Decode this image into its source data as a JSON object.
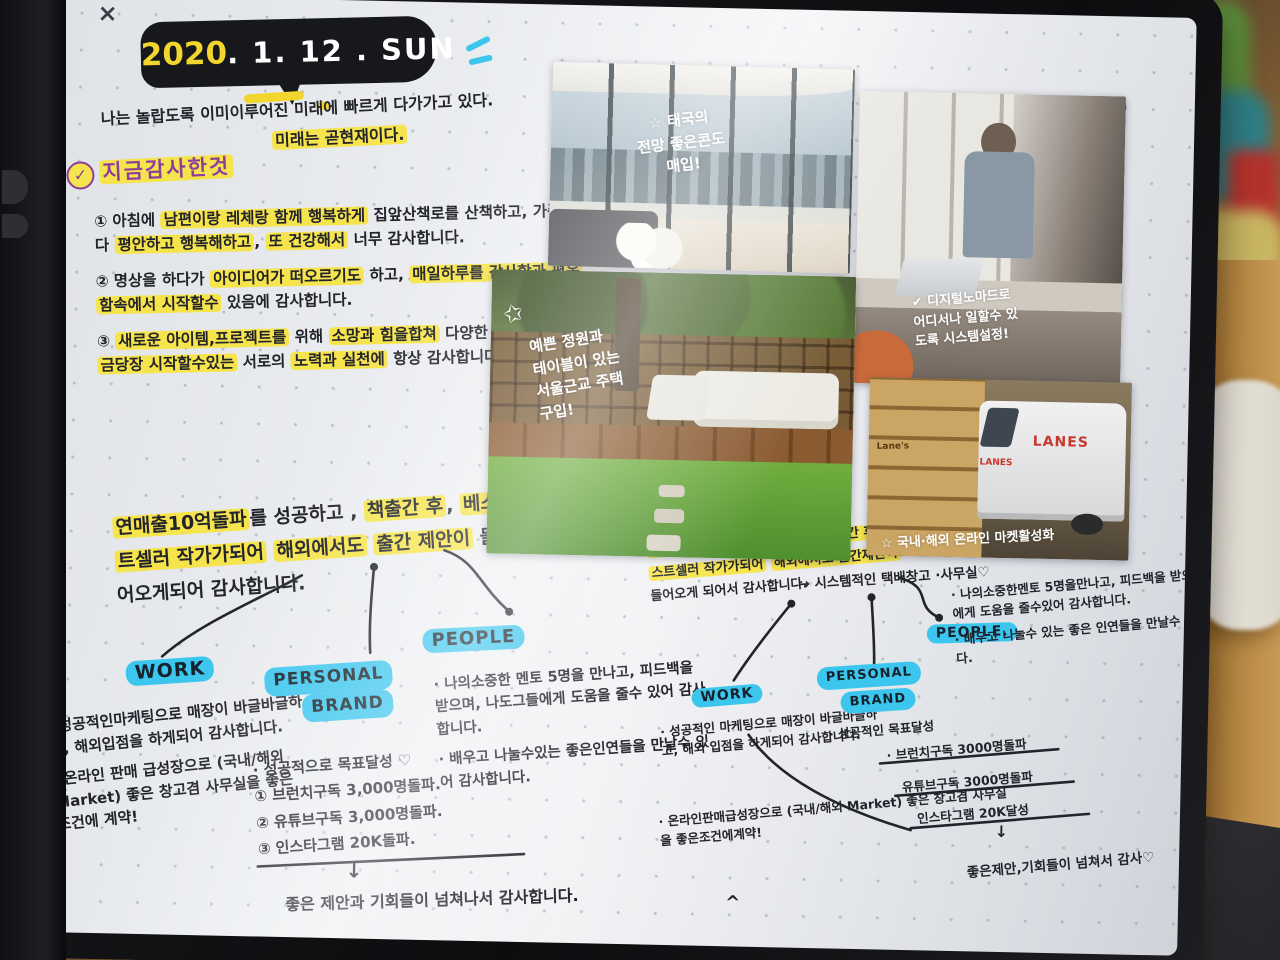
{
  "scene": {
    "close_icon": "×",
    "undo_icon": "↺",
    "redo_icon": "↻"
  },
  "colors": {
    "highlight_yellow": "#f7e33c",
    "node_cyan": "#3cc6ee",
    "ink_black": "#23242b",
    "heading_purple": "#8d3f9b",
    "paper": "#edeff2",
    "logo_red": "#c8372d"
  },
  "header": {
    "date_year": "2020",
    "date_rest": ". 1. 12 . SUN",
    "intro_line1": "나는 놀랍도록 이미이루어진 미래에 빠르게 다가가고 있다.",
    "intro_highlight": "미래는 곧현재이다."
  },
  "gratitude": {
    "check": "✓",
    "heading": "지금감사한것",
    "items": [
      {
        "num": "①",
        "segments": [
          {
            "t": "아침에 ",
            "hl": false
          },
          {
            "t": "남편이랑 레체랑 함께 행복하게",
            "hl": true
          },
          {
            "t": " 집앞산책로를 산책하고, 가족이 다 ",
            "hl": false
          },
          {
            "t": "평안하고 행복해하고",
            "hl": true
          },
          {
            "t": ", ",
            "hl": false
          },
          {
            "t": "또 건강해서",
            "hl": true
          },
          {
            "t": " 너무 감사합니다.",
            "hl": false
          }
        ]
      },
      {
        "num": "②",
        "segments": [
          {
            "t": "명상을 하다가 ",
            "hl": false
          },
          {
            "t": "아이디어가 떠오르기도",
            "hl": true
          },
          {
            "t": " 하고, ",
            "hl": false
          },
          {
            "t": "매일하루를 감사함과 평온함속에서 시작할수",
            "hl": true
          },
          {
            "t": " 있음에 감사합니다.",
            "hl": false
          }
        ]
      },
      {
        "num": "③",
        "segments": [
          {
            "t": "새로운 아이템,프로젝트를",
            "hl": true
          },
          {
            "t": " 위해 ",
            "hl": false
          },
          {
            "t": "소망과 힘을합쳐",
            "hl": true
          },
          {
            "t": " 다양한 방식으로 ",
            "hl": false
          },
          {
            "t": "지금당장 시작할수있는",
            "hl": true
          },
          {
            "t": " 서로의 ",
            "hl": false
          },
          {
            "t": "노력과 실천에",
            "hl": true
          },
          {
            "t": " 항상 감사합니다.",
            "hl": false
          }
        ]
      }
    ]
  },
  "left": {
    "summary": {
      "segments": [
        {
          "t": "연매출10억돌파",
          "hl": true
        },
        {
          "t": "를 성공하고 , ",
          "hl": false
        },
        {
          "t": "책출간 후",
          "hl": true
        },
        {
          "t": ", ",
          "hl": false
        },
        {
          "t": "베스트셀러 작가가되어",
          "hl": true
        },
        {
          "t": " ",
          "hl": false
        },
        {
          "t": "해외에서도",
          "hl": true
        },
        {
          "t": " ",
          "hl": false
        },
        {
          "t": "출간 제안이",
          "hl": true
        },
        {
          "t": " 들어오게되어 감사합니다.",
          "hl": false
        }
      ]
    },
    "work": {
      "label": "WORK",
      "bullets": [
        "· 성공적인마케팅으로 매장이 바글바글하고, 해외입점을 하게되어 감사합니다.",
        "· 온라인 판매 급성장으로 (국내/해외 Market) 좋은 창고겸 사무실을 좋은 조건에 계약!"
      ]
    },
    "pb": {
      "label1": "PERSONAL",
      "label2": "BRAND",
      "intro": "· 성공적으로 목표달성 ♡",
      "goals": [
        {
          "num": "①",
          "text": "브런치구독 3,000명돌파."
        },
        {
          "num": "②",
          "text": "유튜브구독 3,000명돌파."
        },
        {
          "num": "③",
          "text": "인스타그램 20K돌파."
        }
      ],
      "arrow": "↓",
      "footer": "좋은 제안과 기회들이 넘쳐나서 감사합니다."
    },
    "people": {
      "label": "PEOPLE",
      "bullets": [
        "· 나의소중한 멘토 5명을 만나고, 피드백을 받으며, 나도그들에게 도움을 줄수 있어 감사합니다.",
        "· 배우고 나눌수있는 좋은인연들을 만날수 있어 감사합니다."
      ]
    }
  },
  "right": {
    "summary": {
      "segments": [
        {
          "t": "연매출 10억돌파에",
          "hl": true
        },
        {
          "t": " 성공하고, ",
          "hl": false
        },
        {
          "t": "책출간 후",
          "hl": true
        },
        {
          "t": ". ",
          "hl": false
        },
        {
          "t": "베스트셀러 작가가되어",
          "hl": true
        },
        {
          "t": " ",
          "hl": false
        },
        {
          "t": "해외에서도 출간제안이",
          "hl": true
        },
        {
          "t": " 들어오게 되어서 감사합니다.",
          "hl": false
        }
      ]
    },
    "work": {
      "label": "WORK",
      "bullets": [
        "· 성공적인 마케팅으로 매장이 바글바글하고, 해외 입점을 하게되어 감사합니다.",
        "· 온라인판매급성장으로 (국내/해외 Market) 좋은 창고겸 사무실을 좋은조건에계약!"
      ]
    },
    "pb": {
      "label1": "PERSONAL",
      "label2": "BRAND",
      "intro": "· 성공적인 목표달성",
      "goals": [
        "· 브런치구독 3000명돌파",
        "유튜브구독 3000명돌파",
        "인스타그램 20K달성"
      ],
      "arrow": "↓",
      "footer": "좋은제안,기회들이 넘쳐서 감사♡"
    },
    "people": {
      "label": "PEOPLE.",
      "bullets": [
        "· 나의소중한멘토 5명을만나고, 피드백을 받으며 나도그들에게 도움을 줄수있어 감사합니다.",
        "· 배우고 나눌수 있는 좋은 인연들을 만날수 있어 감사합니다."
      ]
    },
    "caret": "^"
  },
  "photos": [
    {
      "caption": "☆ 태국의\n전망 좋은콘도\n매입!"
    },
    {
      "caption": "✔ 디지털노마드로\n어디서나 일할수 있\n도록 시스템설정!"
    },
    {
      "star": "✩",
      "caption": "예쁜 정원과\n테이블이 있는\n서울근교 주택\n구입!"
    },
    {
      "caption": "☆ 국내·해외 온라인 마켓활성화",
      "subcaption": "→ 시스템적인 택배창고 ·사무실♡",
      "logo": "LANES",
      "box_label": "Lane's"
    }
  ]
}
